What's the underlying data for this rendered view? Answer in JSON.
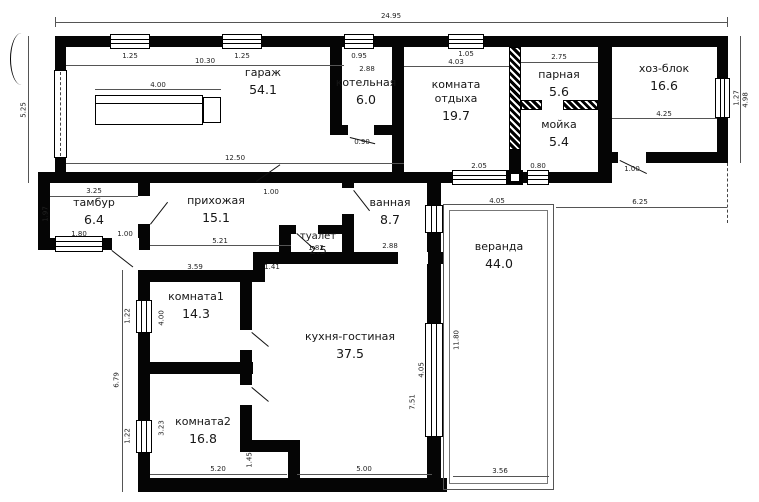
{
  "plan": {
    "type": "floor-plan",
    "language": "ru",
    "units": "m"
  },
  "rooms": [
    {
      "id": "garage",
      "name": "гараж",
      "area": "54.1"
    },
    {
      "id": "boiler",
      "name": "котельная",
      "area": "6.0"
    },
    {
      "id": "rest",
      "name": "комната отдыха",
      "area": "19.7"
    },
    {
      "id": "steam",
      "name": "парная",
      "area": "5.6"
    },
    {
      "id": "wash",
      "name": "мойка",
      "area": "5.4"
    },
    {
      "id": "utility",
      "name": "хоз-блок",
      "area": "16.6"
    },
    {
      "id": "tambour",
      "name": "тамбур",
      "area": "6.4"
    },
    {
      "id": "hall",
      "name": "прихожая",
      "area": "15.1"
    },
    {
      "id": "toilet",
      "name": "туалет",
      "area": "2.5"
    },
    {
      "id": "bath",
      "name": "ванная",
      "area": "8.7"
    },
    {
      "id": "veranda",
      "name": "веранда",
      "area": "44.0"
    },
    {
      "id": "room1",
      "name": "комната1",
      "area": "14.3"
    },
    {
      "id": "kitchen",
      "name": "кухня-гостиная",
      "area": "37.5"
    },
    {
      "id": "room2",
      "name": "комната2",
      "area": "16.8"
    }
  ],
  "dims": {
    "total_w": "24.95",
    "garage_top": "10.30",
    "garage_bot": "12.50",
    "bench": "4.00",
    "rest_top": "4.03",
    "steam_top": "2.75",
    "hoz_top": "4.25",
    "tambur_top": "3.25",
    "hall_bot": "5.21",
    "room1_top": "3.59",
    "nook": "1.41",
    "bath_bot": "2.88",
    "boiler_top": "2.88",
    "toilet_bot": "1.82",
    "win_rest": "2.05",
    "win_wash": "0.80",
    "veranda_top": "4.05",
    "right_offset": "6.25",
    "room2_bot": "5.20",
    "kitchen_bot": "5.00",
    "veranda_bot": "3.56",
    "step": "1.45",
    "veranda_h": "11.80",
    "kitchen_h": "7.51",
    "kitchen_win": "4.05",
    "left_top": "5.25",
    "left_bot": "6.79",
    "right_h": "4.98",
    "room1_h": "4.00",
    "room2_h": "3.23",
    "tambur_h": "1.97",
    "boiler_door": "0.90",
    "door": "1.00",
    "tambur_win": "1.80",
    "win1": "1.25",
    "win2": "1.25",
    "win3": "0.95",
    "win4": "1.05",
    "win_right": "1.27",
    "win_left": "1.22"
  }
}
